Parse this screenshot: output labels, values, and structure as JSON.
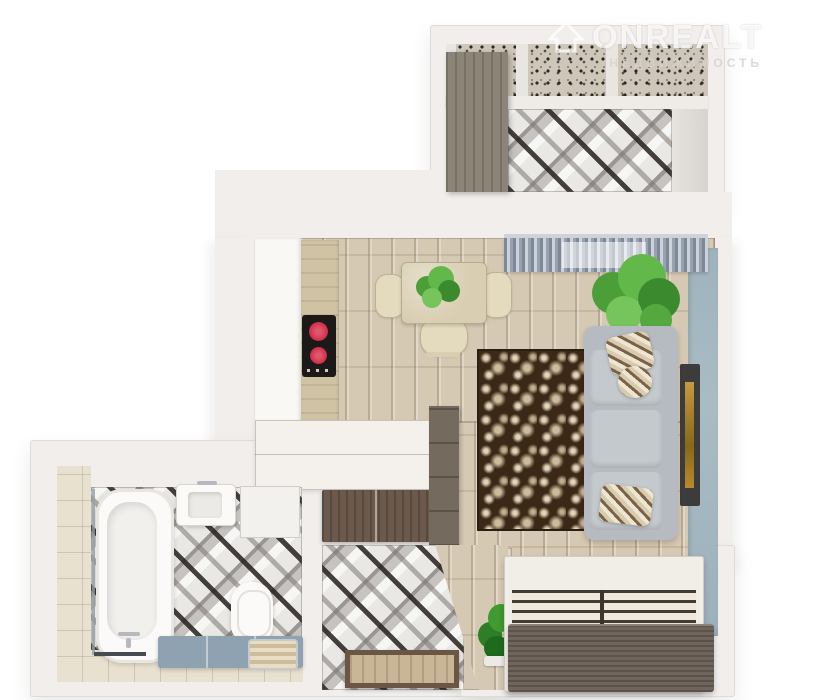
{
  "watermark": {
    "brand": "ONREALT",
    "subtitle": "НЕДВИЖИМОСТЬ"
  },
  "palette": {
    "wall": "#f1eeec",
    "wood_floor": "#d6c9b3",
    "accent_wall_blue": "#a7bac3",
    "geometric_tile_dark": "#2c2824",
    "bath_wall_tile": "#e9e1cf",
    "rug_brown": "#3b2817",
    "rug_ornament_cream": "#e8dcc0",
    "sofa_gray": "#b5bbc1",
    "picture_frame_gold": "#bb8c2f",
    "plant_green": "#4c9e38",
    "cooktop_burner_red": "#d4344e",
    "bench_blue": "#8ea2b1",
    "cabinet_dark_wood": "#6b5a4b",
    "door_brown": "#6b5646"
  },
  "scene": {
    "type": "3d-floorplan-top-view",
    "rooms": [
      "balcony",
      "kitchen-living-room",
      "bathroom",
      "hallway",
      "sleeping-area"
    ],
    "items": [
      "wardrobe",
      "window-speckled-view",
      "geometric-tile-floor",
      "kitchen-cabinets",
      "induction-cooktop",
      "dining-table",
      "chairs",
      "table-plant",
      "curtained-window",
      "large-plant",
      "gray-sofa",
      "patterned-pillows",
      "damask-rug",
      "wall-picture",
      "blue-accent-wall",
      "bar-peninsula",
      "dark-sideboard",
      "tall-cabinet",
      "bathtub",
      "sink",
      "washer-panel",
      "toilet",
      "blue-bench",
      "towels",
      "entry-door",
      "hallway-plant",
      "bed-frame-with-slats"
    ]
  }
}
